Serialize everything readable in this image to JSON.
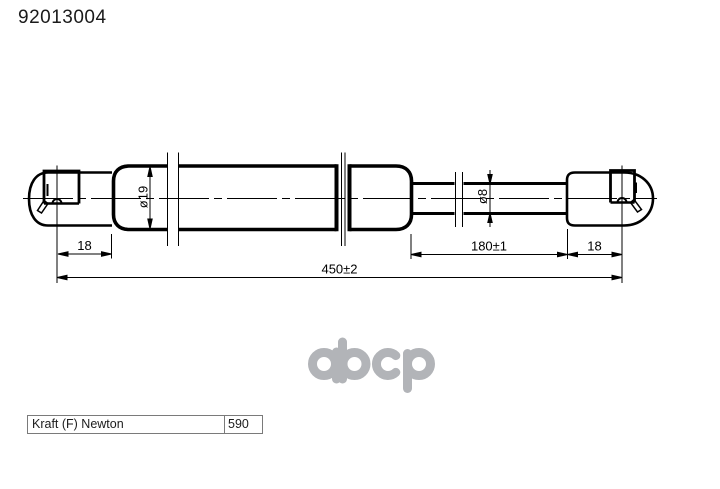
{
  "page": {
    "title": "92013004"
  },
  "drawing": {
    "dimensions": {
      "body_diameter": "ø19",
      "rod_diameter": "ø8",
      "left_eye_offset": "18",
      "extension_length": "180±1",
      "right_eye_offset": "18",
      "overall_length": "450±2"
    },
    "line_color": "#000000"
  },
  "watermark": {
    "text": "abcp",
    "color": "#b2b4b8"
  },
  "spec_table": {
    "rows": [
      {
        "label": "Kraft (F) Newton",
        "value": "590"
      }
    ]
  }
}
